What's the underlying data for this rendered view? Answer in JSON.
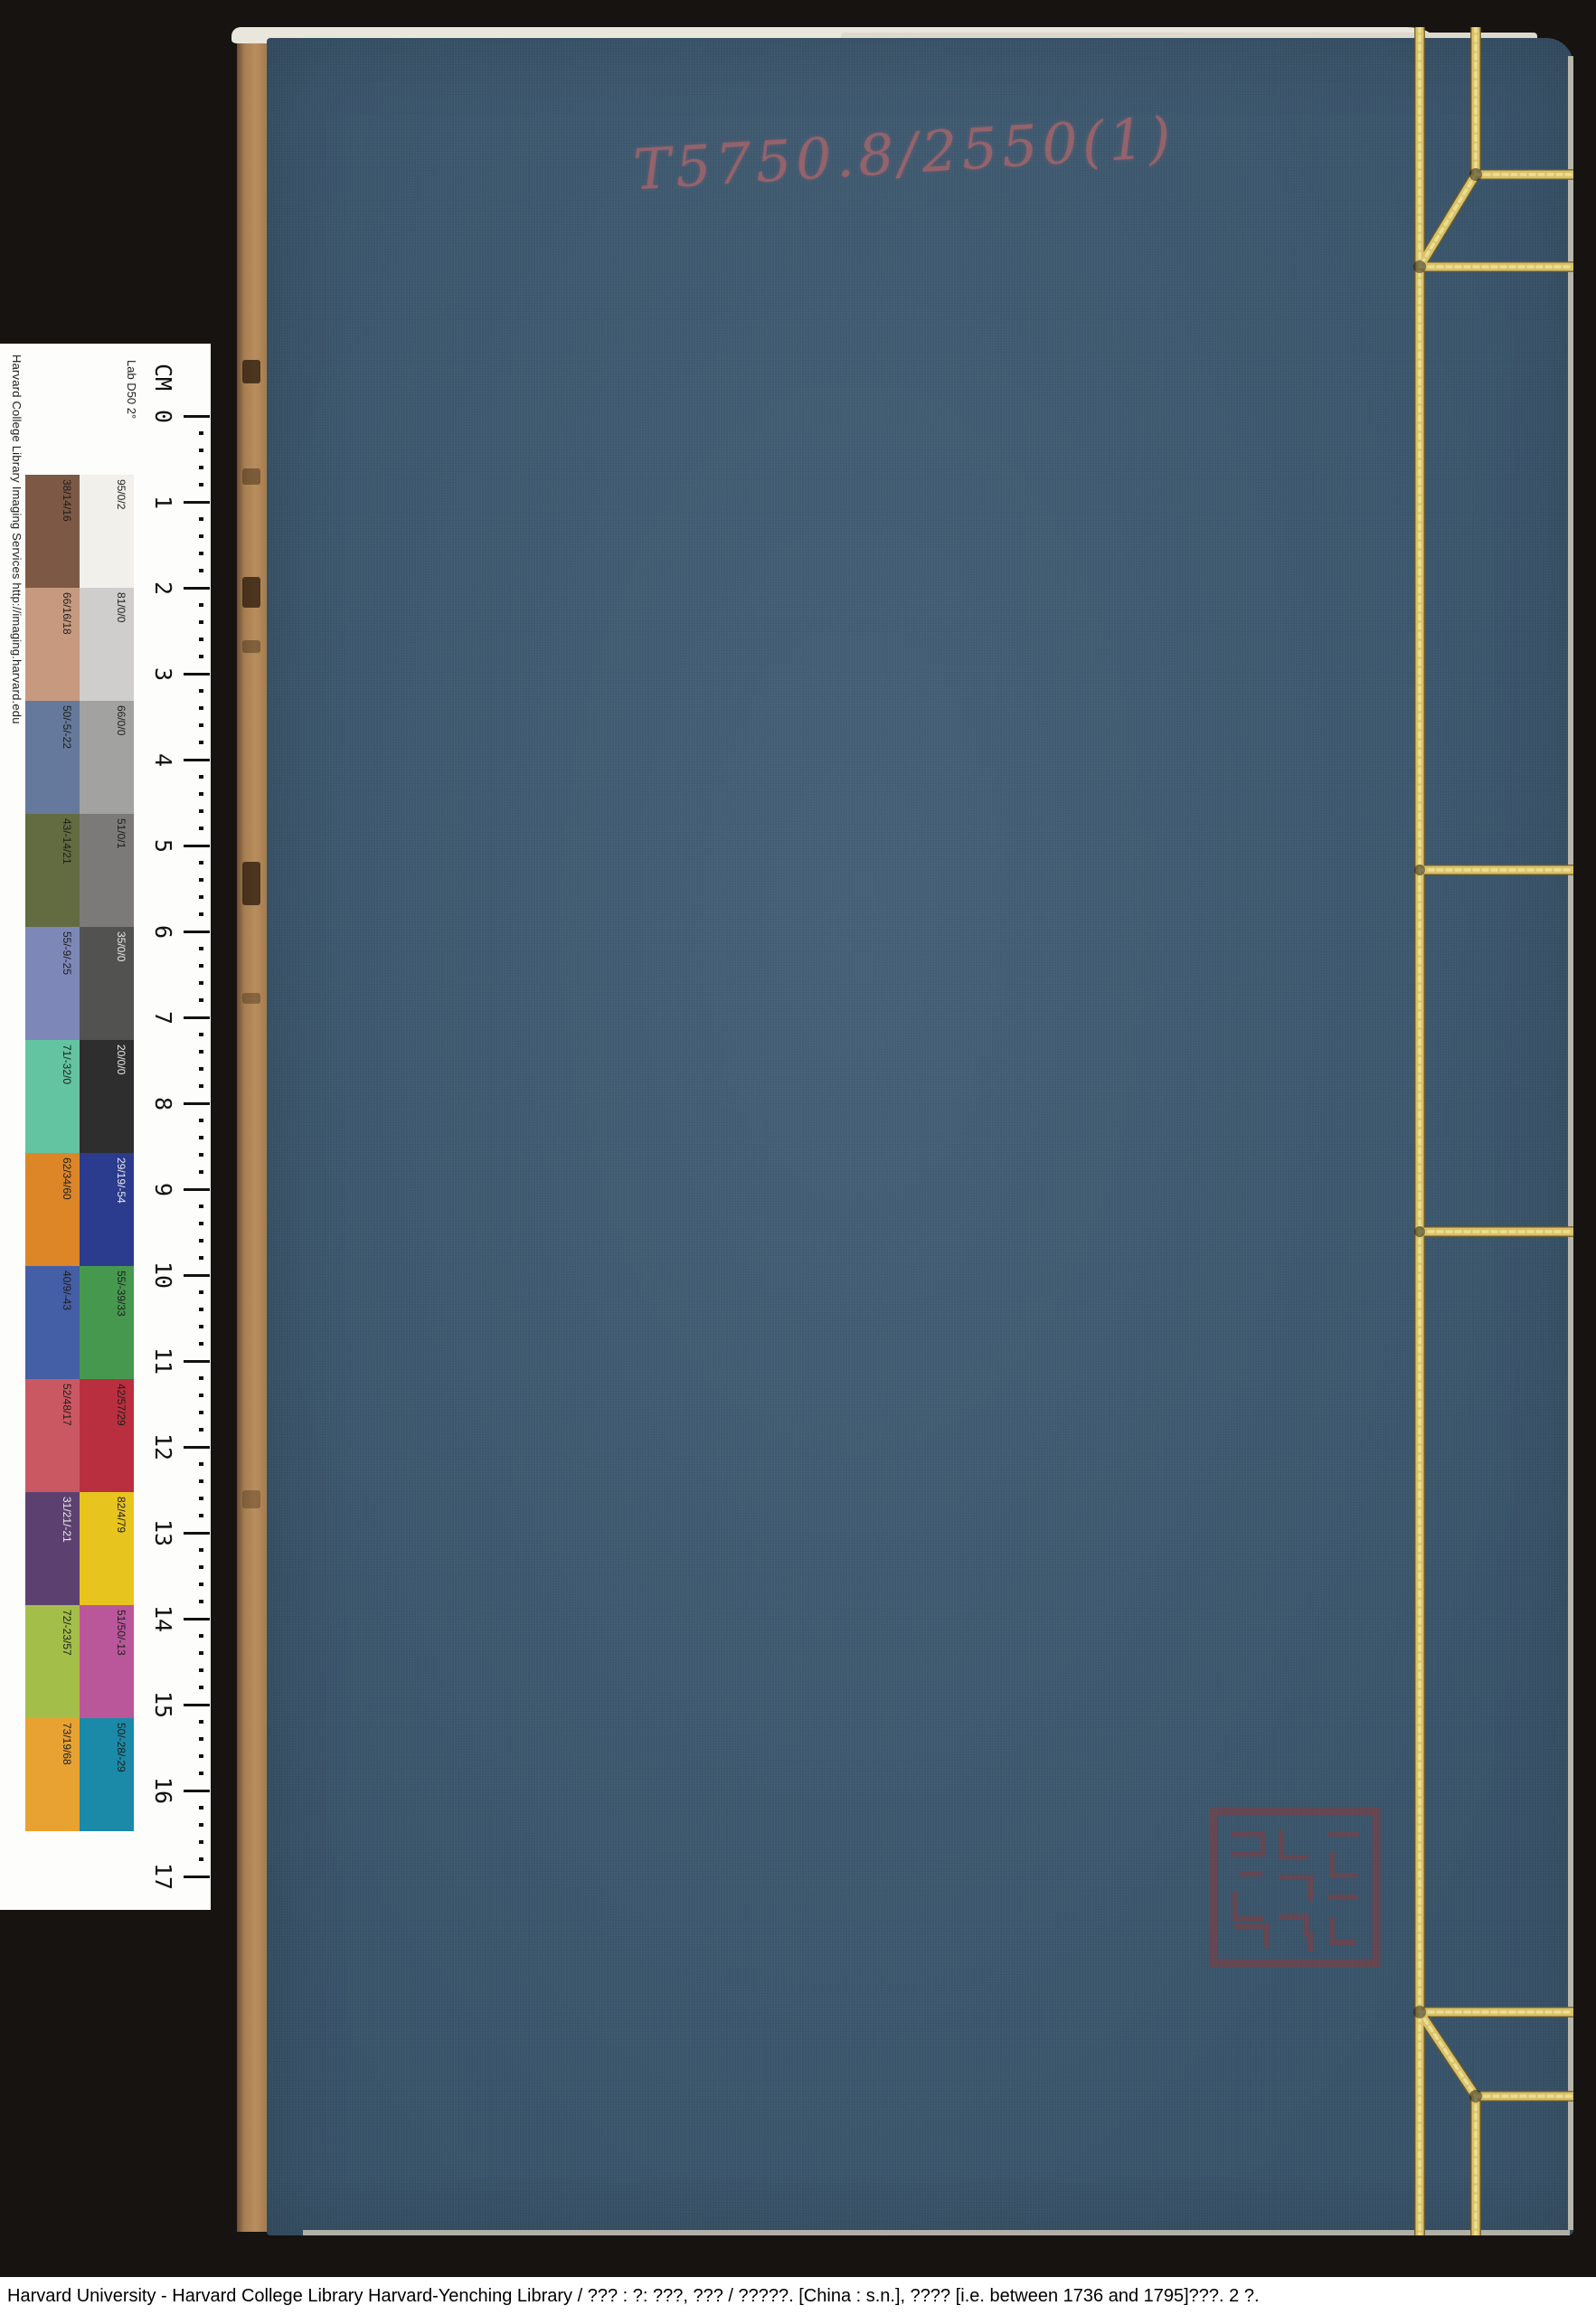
{
  "caption": {
    "text": "Harvard University - Harvard College Library Harvard-Yenching Library / ??? : ?: ???, ??? / ?????. [China : s.n.], ???? [i.e. between 1736 and 1795]???.  2 ?."
  },
  "book": {
    "call_number": "T5750.8/2550(1)",
    "cover_color": "#3d5971",
    "thread_color": "#d9c267",
    "seal_color": "#8c3a3a"
  },
  "scale_bar": {
    "attribution": "Harvard College Library Imaging Services http://imaging.harvard.edu",
    "colorspace_label": "Lab D50 2°",
    "ruler": {
      "unit": "CM",
      "numbers": [
        "0",
        "1",
        "2",
        "3",
        "4",
        "5",
        "6",
        "7",
        "8",
        "9",
        "10",
        "11",
        "12",
        "13",
        "14",
        "15",
        "16",
        "17"
      ]
    },
    "patches": [
      {
        "left": {
          "label": "38/14/16",
          "color": "#7d5945",
          "text": "#1d1d1d"
        },
        "right": {
          "label": "95/0/2",
          "color": "#f2f0ea",
          "text": "#1d1d1d"
        }
      },
      {
        "left": {
          "label": "66/16/18",
          "color": "#c79a80",
          "text": "#1d1d1d"
        },
        "right": {
          "label": "81/0/0",
          "color": "#cfcecc",
          "text": "#1d1d1d"
        }
      },
      {
        "left": {
          "label": "50/-5/-22",
          "color": "#64799b",
          "text": "#1d1d1d"
        },
        "right": {
          "label": "66/0/0",
          "color": "#a2a2a0",
          "text": "#1d1d1d"
        }
      },
      {
        "left": {
          "label": "43/-14/21",
          "color": "#626c40",
          "text": "#1d1d1d"
        },
        "right": {
          "label": "51/0/1",
          "color": "#7b7a78",
          "text": "#1d1d1d"
        }
      },
      {
        "left": {
          "label": "55/-9/-25",
          "color": "#7d87b8",
          "text": "#1d1d1d"
        },
        "right": {
          "label": "35/0/0",
          "color": "#525251",
          "text": "#e9e9e9"
        }
      },
      {
        "left": {
          "label": "71/-32/0",
          "color": "#63c4a2",
          "text": "#1d1d1d"
        },
        "right": {
          "label": "20/0/0",
          "color": "#2e2e2e",
          "text": "#e9e9e9"
        }
      },
      {
        "left": {
          "label": "62/34/60",
          "color": "#dc8628",
          "text": "#1d1d1d"
        },
        "right": {
          "label": "29/19/-54",
          "color": "#2b3b8d",
          "text": "#e9e9e9"
        }
      },
      {
        "left": {
          "label": "40/9/-43",
          "color": "#455fa6",
          "text": "#1d1d1d"
        },
        "right": {
          "label": "55/-39/33",
          "color": "#46984e",
          "text": "#1d1d1d"
        }
      },
      {
        "left": {
          "label": "52/48/17",
          "color": "#ca5862",
          "text": "#1d1d1d"
        },
        "right": {
          "label": "42/57/29",
          "color": "#b92f40",
          "text": "#1d1d1d"
        }
      },
      {
        "left": {
          "label": "31/21/-21",
          "color": "#5c4170",
          "text": "#e9e9e9"
        },
        "right": {
          "label": "82/4/79",
          "color": "#e8c41e",
          "text": "#1d1d1d"
        }
      },
      {
        "left": {
          "label": "72/-23/57",
          "color": "#a4be4a",
          "text": "#1d1d1d"
        },
        "right": {
          "label": "51/50/-13",
          "color": "#ba579a",
          "text": "#1d1d1d"
        }
      },
      {
        "left": {
          "label": "73/19/68",
          "color": "#e8a232",
          "text": "#1d1d1d"
        },
        "right": {
          "label": "50/-28/-29",
          "color": "#1a8aa8",
          "text": "#1d1d1d"
        }
      }
    ]
  }
}
